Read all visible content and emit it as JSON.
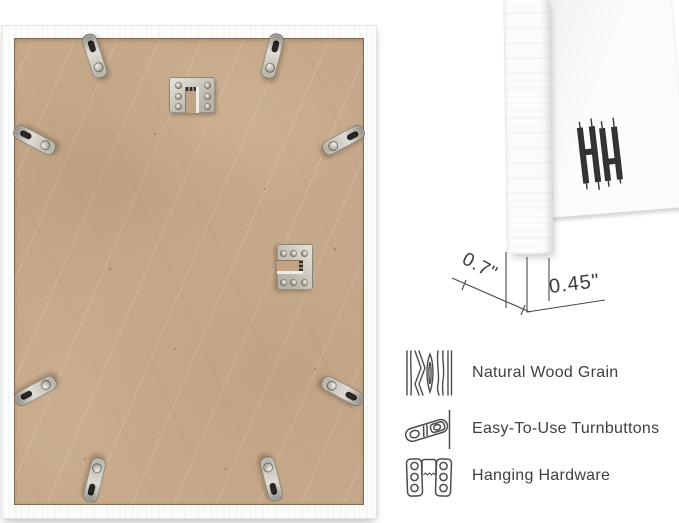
{
  "measurements": {
    "depth": "0.7\"",
    "face_width": "0.45\""
  },
  "features": [
    {
      "icon": "wood-grain-icon",
      "label": "Natural Wood Grain"
    },
    {
      "icon": "turnbutton-icon",
      "label": "Easy-To-Use Turnbuttons"
    },
    {
      "icon": "hanging-hardware-icon",
      "label": "Hanging Hardware"
    }
  ],
  "icons": {
    "logo": "brand-monogram-logo"
  },
  "colors": {
    "background": "#ffffff",
    "frame_white": "#fcfcfb",
    "mdf_board": "#c6a98b",
    "metal_hardware": "#c9c6bd",
    "annotation": "#3d3d3d"
  }
}
